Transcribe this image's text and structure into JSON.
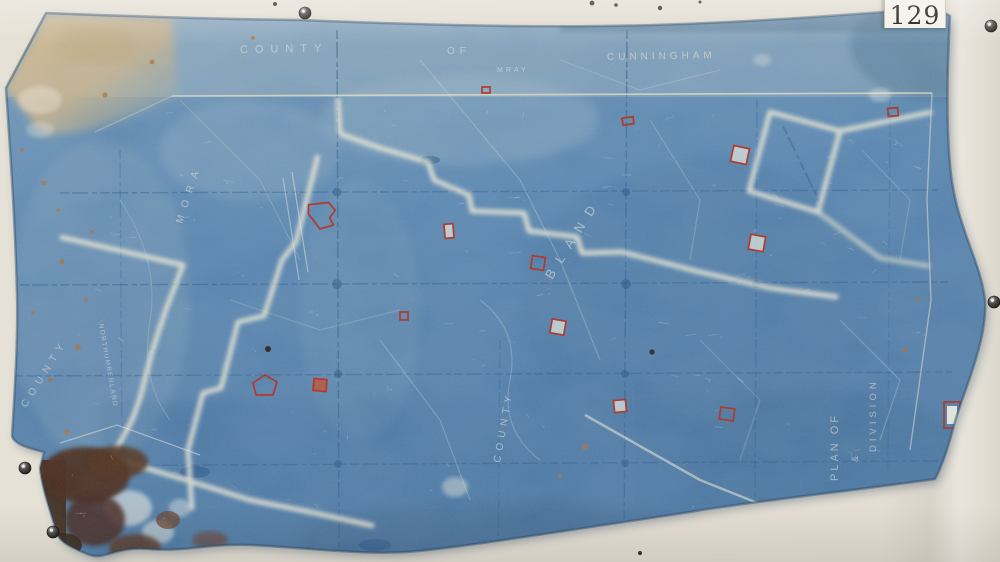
{
  "photo": {
    "catalog_label": "129",
    "colors": {
      "backdrop": "#e3ddd2",
      "blueprint_blue": "#4a7aa8",
      "boundary_cream": "#e7e3cf",
      "marker_red": "#b23a2c",
      "stain_brown": "#43200e",
      "label_paper": "#f4f1e9"
    }
  },
  "map": {
    "header": {
      "word_county": "COUNTY",
      "word_of": "OF",
      "county_name": "CUNNINGHAM",
      "faint_note": "MRAY"
    },
    "region_labels": {
      "left_diagonal_county": "COUNTY",
      "left_diagonal_name": "MORA",
      "left_vertical_name": "NORTHUMBERLAND",
      "central_name": "BLAND",
      "bottom_vertical_county": "COUNTY"
    },
    "title_block": {
      "line1": "PLAN OF",
      "line2": "&",
      "line3": "DIVISION"
    },
    "markers": [
      {
        "x": 628,
        "y": 121,
        "w": 11,
        "h": 7,
        "rot": -8,
        "fill": "none",
        "shape": "rect"
      },
      {
        "x": 740,
        "y": 155,
        "w": 16,
        "h": 16,
        "rot": 12,
        "fill": "light",
        "shape": "rect"
      },
      {
        "x": 893,
        "y": 112,
        "w": 10,
        "h": 8,
        "rot": -5,
        "fill": "none",
        "shape": "rect"
      },
      {
        "x": 757,
        "y": 243,
        "w": 15,
        "h": 15,
        "rot": 10,
        "fill": "light",
        "shape": "rect"
      },
      {
        "x": 449,
        "y": 231,
        "w": 9,
        "h": 14,
        "rot": -5,
        "fill": "light",
        "shape": "rect"
      },
      {
        "x": 538,
        "y": 263,
        "w": 13,
        "h": 13,
        "rot": 8,
        "fill": "none",
        "shape": "rect"
      },
      {
        "x": 558,
        "y": 327,
        "w": 14,
        "h": 14,
        "rot": 10,
        "fill": "light",
        "shape": "rect"
      },
      {
        "x": 404,
        "y": 316,
        "w": 8,
        "h": 8,
        "rot": 0,
        "fill": "none",
        "shape": "rect"
      },
      {
        "x": 323,
        "y": 215,
        "w": 30,
        "h": 26,
        "rot": -12,
        "fill": "none",
        "shape": "blob"
      },
      {
        "x": 265,
        "y": 385,
        "w": 24,
        "h": 20,
        "rot": 0,
        "fill": "none",
        "shape": "pentagon"
      },
      {
        "x": 320,
        "y": 385,
        "w": 13,
        "h": 12,
        "rot": 5,
        "fill": "solid",
        "shape": "rect"
      },
      {
        "x": 620,
        "y": 406,
        "w": 12,
        "h": 12,
        "rot": -6,
        "fill": "light",
        "shape": "rect"
      },
      {
        "x": 727,
        "y": 414,
        "w": 14,
        "h": 12,
        "rot": 8,
        "fill": "none",
        "shape": "rect"
      },
      {
        "x": 486,
        "y": 90,
        "w": 8,
        "h": 6,
        "rot": 0,
        "fill": "none",
        "shape": "rect"
      },
      {
        "x": 952,
        "y": 415,
        "w": 16,
        "h": 26,
        "rot": 0,
        "fill": "bar",
        "shape": "rect"
      }
    ],
    "pins": [
      {
        "x": 305,
        "y": 13
      },
      {
        "x": 991,
        "y": 26
      },
      {
        "x": 994,
        "y": 302
      },
      {
        "x": 25,
        "y": 468
      },
      {
        "x": 53,
        "y": 532
      }
    ]
  }
}
